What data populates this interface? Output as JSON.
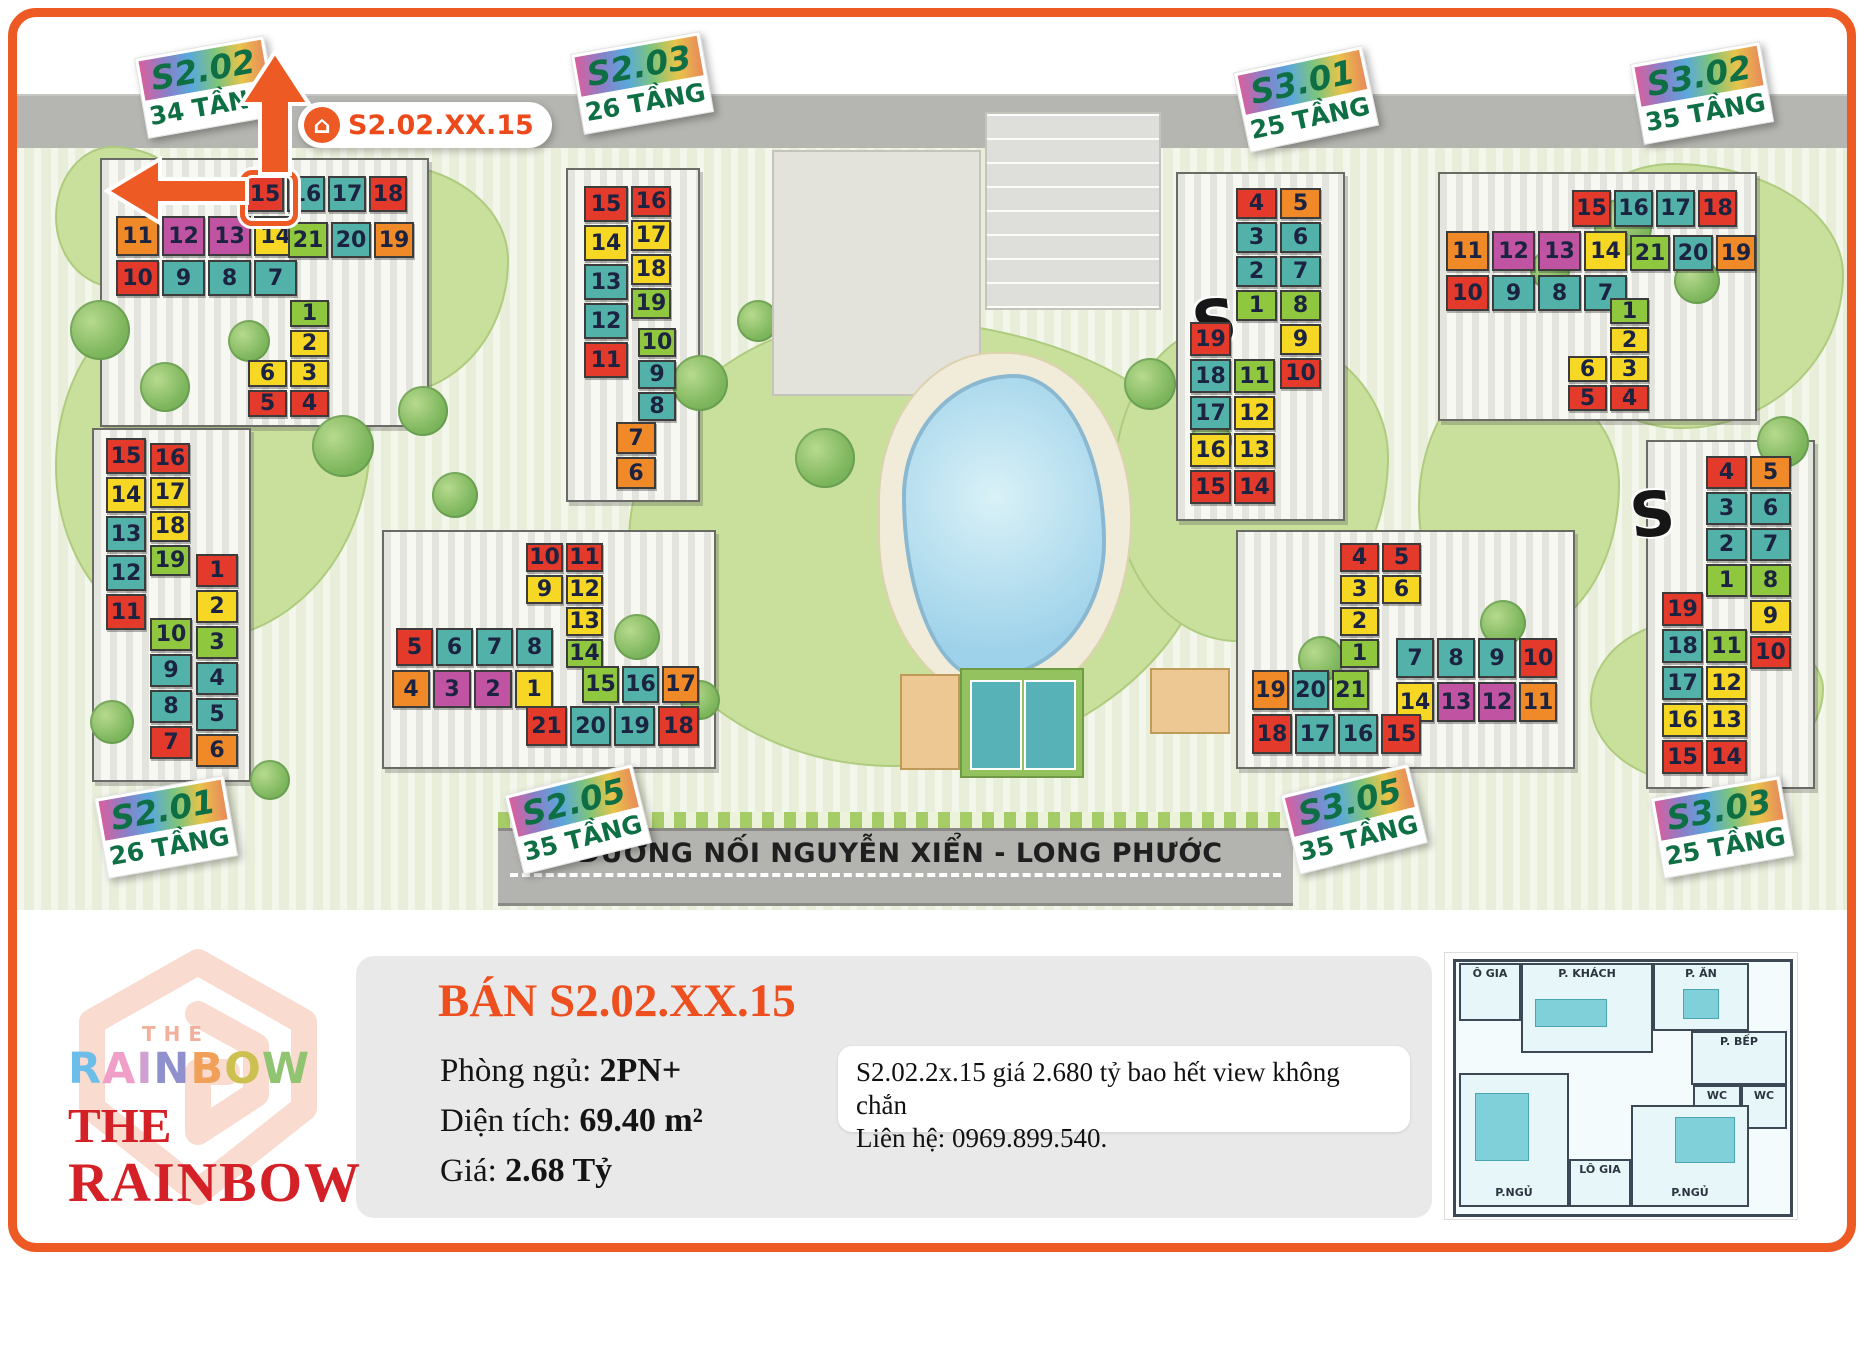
{
  "map": {
    "road_bottom_label": "ĐƯỜNG NỐI NGUYỄN XIỂN - LONG PHƯỚC",
    "highlight_badge": "S2.02.XX.15",
    "watermarks": [
      "S",
      "S"
    ]
  },
  "buildings": [
    {
      "id": "s202",
      "name": "S2.02",
      "floors": "34 TẦNG",
      "highlight_unit": "15",
      "groups": [
        {
          "kind": "row",
          "cells": [
            [
              "15",
              "red"
            ],
            [
              "16",
              "teal"
            ],
            [
              "17",
              "teal"
            ],
            [
              "18",
              "red"
            ]
          ]
        },
        {
          "kind": "row",
          "cells": [
            [
              "11",
              "orange"
            ],
            [
              "12",
              "magenta"
            ],
            [
              "13",
              "magenta"
            ],
            [
              "14",
              "yellow"
            ]
          ]
        },
        {
          "kind": "row",
          "cells": [
            [
              "21",
              "green"
            ],
            [
              "20",
              "teal"
            ],
            [
              "19",
              "orange"
            ]
          ]
        },
        {
          "kind": "row",
          "cells": [
            [
              "10",
              "red"
            ],
            [
              "9",
              "teal"
            ],
            [
              "8",
              "teal"
            ],
            [
              "7",
              "teal"
            ]
          ]
        },
        {
          "kind": "grid",
          "rows": [
            [
              null,
              [
                "1",
                "green"
              ]
            ],
            [
              null,
              [
                "2",
                "yellow"
              ]
            ],
            [
              [
                "6",
                "yellow"
              ],
              [
                "3",
                "yellow"
              ]
            ],
            [
              [
                "5",
                "red"
              ],
              [
                "4",
                "red"
              ]
            ]
          ]
        }
      ]
    },
    {
      "id": "s203",
      "name": "S2.03",
      "floors": "26 TẦNG",
      "groups": [
        {
          "kind": "col",
          "cells": [
            [
              "15",
              "red"
            ],
            [
              "14",
              "yellow"
            ],
            [
              "13",
              "teal"
            ],
            [
              "12",
              "teal"
            ],
            [
              "11",
              "red"
            ]
          ]
        },
        {
          "kind": "col",
          "cells": [
            [
              "16",
              "red"
            ],
            [
              "17",
              "yellow"
            ],
            [
              "18",
              "yellow"
            ],
            [
              "19",
              "green"
            ]
          ]
        },
        {
          "kind": "col",
          "cells": [
            [
              "10",
              "green"
            ],
            [
              "9",
              "teal"
            ],
            [
              "8",
              "teal"
            ]
          ]
        },
        {
          "kind": "col",
          "cells": [
            [
              "7",
              "orange"
            ],
            [
              "6",
              "orange"
            ]
          ]
        }
      ]
    },
    {
      "id": "s301",
      "name": "S3.01",
      "floors": "25 TẦNG",
      "groups": [
        {
          "kind": "grid",
          "rows": [
            [
              [
                "4",
                "red"
              ],
              [
                "5",
                "orange"
              ]
            ],
            [
              [
                "3",
                "teal"
              ],
              [
                "6",
                "teal"
              ]
            ],
            [
              [
                "2",
                "teal"
              ],
              [
                "7",
                "teal"
              ]
            ],
            [
              [
                "1",
                "green"
              ],
              [
                "8",
                "green"
              ]
            ],
            [
              null,
              [
                "9",
                "yellow"
              ]
            ],
            [
              null,
              [
                "10",
                "red"
              ]
            ]
          ]
        },
        {
          "kind": "grid",
          "rows": [
            [
              [
                "19",
                "red"
              ],
              null
            ],
            [
              [
                "18",
                "teal"
              ],
              [
                "11",
                "green"
              ]
            ],
            [
              [
                "17",
                "teal"
              ],
              [
                "12",
                "yellow"
              ]
            ],
            [
              [
                "16",
                "yellow"
              ],
              [
                "13",
                "yellow"
              ]
            ],
            [
              [
                "15",
                "red"
              ],
              [
                "14",
                "red"
              ]
            ]
          ]
        }
      ]
    },
    {
      "id": "s302",
      "name": "S3.02",
      "floors": "35 TẦNG",
      "groups": [
        {
          "kind": "row",
          "cells": [
            [
              "15",
              "red"
            ],
            [
              "16",
              "teal"
            ],
            [
              "17",
              "teal"
            ],
            [
              "18",
              "red"
            ]
          ]
        },
        {
          "kind": "row",
          "cells": [
            [
              "11",
              "orange"
            ],
            [
              "12",
              "magenta"
            ],
            [
              "13",
              "magenta"
            ],
            [
              "14",
              "yellow"
            ]
          ]
        },
        {
          "kind": "row",
          "cells": [
            [
              "21",
              "green"
            ],
            [
              "20",
              "teal"
            ],
            [
              "19",
              "orange"
            ]
          ]
        },
        {
          "kind": "row",
          "cells": [
            [
              "10",
              "red"
            ],
            [
              "9",
              "teal"
            ],
            [
              "8",
              "teal"
            ],
            [
              "7",
              "teal"
            ]
          ]
        },
        {
          "kind": "grid",
          "rows": [
            [
              null,
              [
                "1",
                "green"
              ]
            ],
            [
              null,
              [
                "2",
                "yellow"
              ]
            ],
            [
              [
                "6",
                "yellow"
              ],
              [
                "3",
                "yellow"
              ]
            ],
            [
              [
                "5",
                "red"
              ],
              [
                "4",
                "red"
              ]
            ]
          ]
        }
      ]
    },
    {
      "id": "s201",
      "name": "S2.01",
      "floors": "26 TẦNG",
      "groups": [
        {
          "kind": "col",
          "cells": [
            [
              "15",
              "red"
            ],
            [
              "14",
              "yellow"
            ],
            [
              "13",
              "teal"
            ],
            [
              "12",
              "teal"
            ],
            [
              "11",
              "red"
            ]
          ]
        },
        {
          "kind": "col",
          "cells": [
            [
              "16",
              "red"
            ],
            [
              "17",
              "yellow"
            ],
            [
              "18",
              "yellow"
            ],
            [
              "19",
              "green"
            ]
          ]
        },
        {
          "kind": "col",
          "cells": [
            [
              "1",
              "red"
            ],
            [
              "2",
              "yellow"
            ],
            [
              "3",
              "green"
            ],
            [
              "4",
              "teal"
            ],
            [
              "5",
              "teal"
            ],
            [
              "6",
              "orange"
            ]
          ]
        },
        {
          "kind": "col",
          "cells": [
            [
              "10",
              "green"
            ],
            [
              "9",
              "teal"
            ],
            [
              "8",
              "teal"
            ],
            [
              "7",
              "red"
            ]
          ]
        }
      ]
    },
    {
      "id": "s205",
      "name": "S2.05",
      "floors": "35 TẦNG",
      "groups": [
        {
          "kind": "grid",
          "rows": [
            [
              [
                "10",
                "red"
              ],
              [
                "11",
                "red"
              ]
            ],
            [
              [
                "9",
                "yellow"
              ],
              [
                "12",
                "yellow"
              ]
            ],
            [
              null,
              [
                "13",
                "yellow"
              ]
            ],
            [
              null,
              [
                "14",
                "green"
              ]
            ]
          ]
        },
        {
          "kind": "row",
          "cells": [
            [
              "5",
              "red"
            ],
            [
              "6",
              "teal"
            ],
            [
              "7",
              "teal"
            ],
            [
              "8",
              "teal"
            ]
          ]
        },
        {
          "kind": "row",
          "cells": [
            [
              "4",
              "orange"
            ],
            [
              "3",
              "magenta"
            ],
            [
              "2",
              "magenta"
            ],
            [
              "1",
              "yellow"
            ]
          ]
        },
        {
          "kind": "row",
          "cells": [
            [
              "15",
              "green"
            ],
            [
              "16",
              "teal"
            ],
            [
              "17",
              "orange"
            ]
          ]
        },
        {
          "kind": "row",
          "cells": [
            [
              "21",
              "red"
            ],
            [
              "20",
              "teal"
            ],
            [
              "19",
              "teal"
            ],
            [
              "18",
              "red"
            ]
          ]
        }
      ]
    },
    {
      "id": "s305",
      "name": "S3.05",
      "floors": "35 TẦNG",
      "groups": [
        {
          "kind": "grid",
          "rows": [
            [
              [
                "4",
                "red"
              ],
              [
                "5",
                "red"
              ]
            ],
            [
              [
                "3",
                "yellow"
              ],
              [
                "6",
                "yellow"
              ]
            ],
            [
              [
                "2",
                "yellow"
              ],
              null
            ],
            [
              [
                "1",
                "green"
              ],
              null
            ]
          ]
        },
        {
          "kind": "row",
          "cells": [
            [
              "7",
              "teal"
            ],
            [
              "8",
              "teal"
            ],
            [
              "9",
              "teal"
            ],
            [
              "10",
              "red"
            ]
          ]
        },
        {
          "kind": "row",
          "cells": [
            [
              "14",
              "yellow"
            ],
            [
              "13",
              "magenta"
            ],
            [
              "12",
              "magenta"
            ],
            [
              "11",
              "orange"
            ]
          ]
        },
        {
          "kind": "row",
          "cells": [
            [
              "19",
              "orange"
            ],
            [
              "20",
              "teal"
            ],
            [
              "21",
              "green"
            ]
          ]
        },
        {
          "kind": "row",
          "cells": [
            [
              "18",
              "red"
            ],
            [
              "17",
              "teal"
            ],
            [
              "16",
              "teal"
            ],
            [
              "15",
              "red"
            ]
          ]
        }
      ]
    },
    {
      "id": "s303",
      "name": "S3.03",
      "floors": "25 TẦNG",
      "groups": [
        {
          "kind": "grid",
          "rows": [
            [
              [
                "4",
                "red"
              ],
              [
                "5",
                "orange"
              ]
            ],
            [
              [
                "3",
                "teal"
              ],
              [
                "6",
                "teal"
              ]
            ],
            [
              [
                "2",
                "teal"
              ],
              [
                "7",
                "teal"
              ]
            ],
            [
              [
                "1",
                "green"
              ],
              [
                "8",
                "green"
              ]
            ],
            [
              null,
              [
                "9",
                "yellow"
              ]
            ],
            [
              null,
              [
                "10",
                "red"
              ]
            ]
          ]
        },
        {
          "kind": "grid",
          "rows": [
            [
              [
                "19",
                "red"
              ],
              null
            ],
            [
              [
                "18",
                "teal"
              ],
              [
                "11",
                "green"
              ]
            ],
            [
              [
                "17",
                "teal"
              ],
              [
                "12",
                "yellow"
              ]
            ],
            [
              [
                "16",
                "yellow"
              ],
              [
                "13",
                "yellow"
              ]
            ],
            [
              [
                "15",
                "red"
              ],
              [
                "14",
                "red"
              ]
            ]
          ]
        }
      ]
    }
  ],
  "info_panel": {
    "title": "BÁN S2.02.XX.15",
    "fields": [
      {
        "label": "Phòng ngủ: ",
        "value": "2PN+"
      },
      {
        "label": "Diện tích: ",
        "value": "69.40 m²"
      },
      {
        "label": "Giá: ",
        "value": "2.68 Tỷ"
      }
    ],
    "note_lines": [
      "S2.02.2x.15 giá 2.680 tỷ bao hết view không chắn",
      "Liên hệ: 0969.899.540."
    ]
  },
  "logo": {
    "the_small": "THE",
    "rainbow_colored": "RAINBOW",
    "the_serif": "THE",
    "rainbow_serif": "RAINBOW",
    "letter_colors": [
      "#6cbde8",
      "#f0a0c8",
      "#d0a0d0",
      "#9090cc",
      "#f0a058",
      "#ccc050",
      "#90c470"
    ],
    "accent": "#ed5a24",
    "red": "#d42027"
  },
  "floorplan": {
    "rooms": [
      "Ô GIA",
      "P. KHÁCH",
      "P. ĂN",
      "P. BẾP",
      "WC",
      "WC",
      "P.NGỦ",
      "P.NGỦ",
      "LÔ GIA"
    ]
  }
}
